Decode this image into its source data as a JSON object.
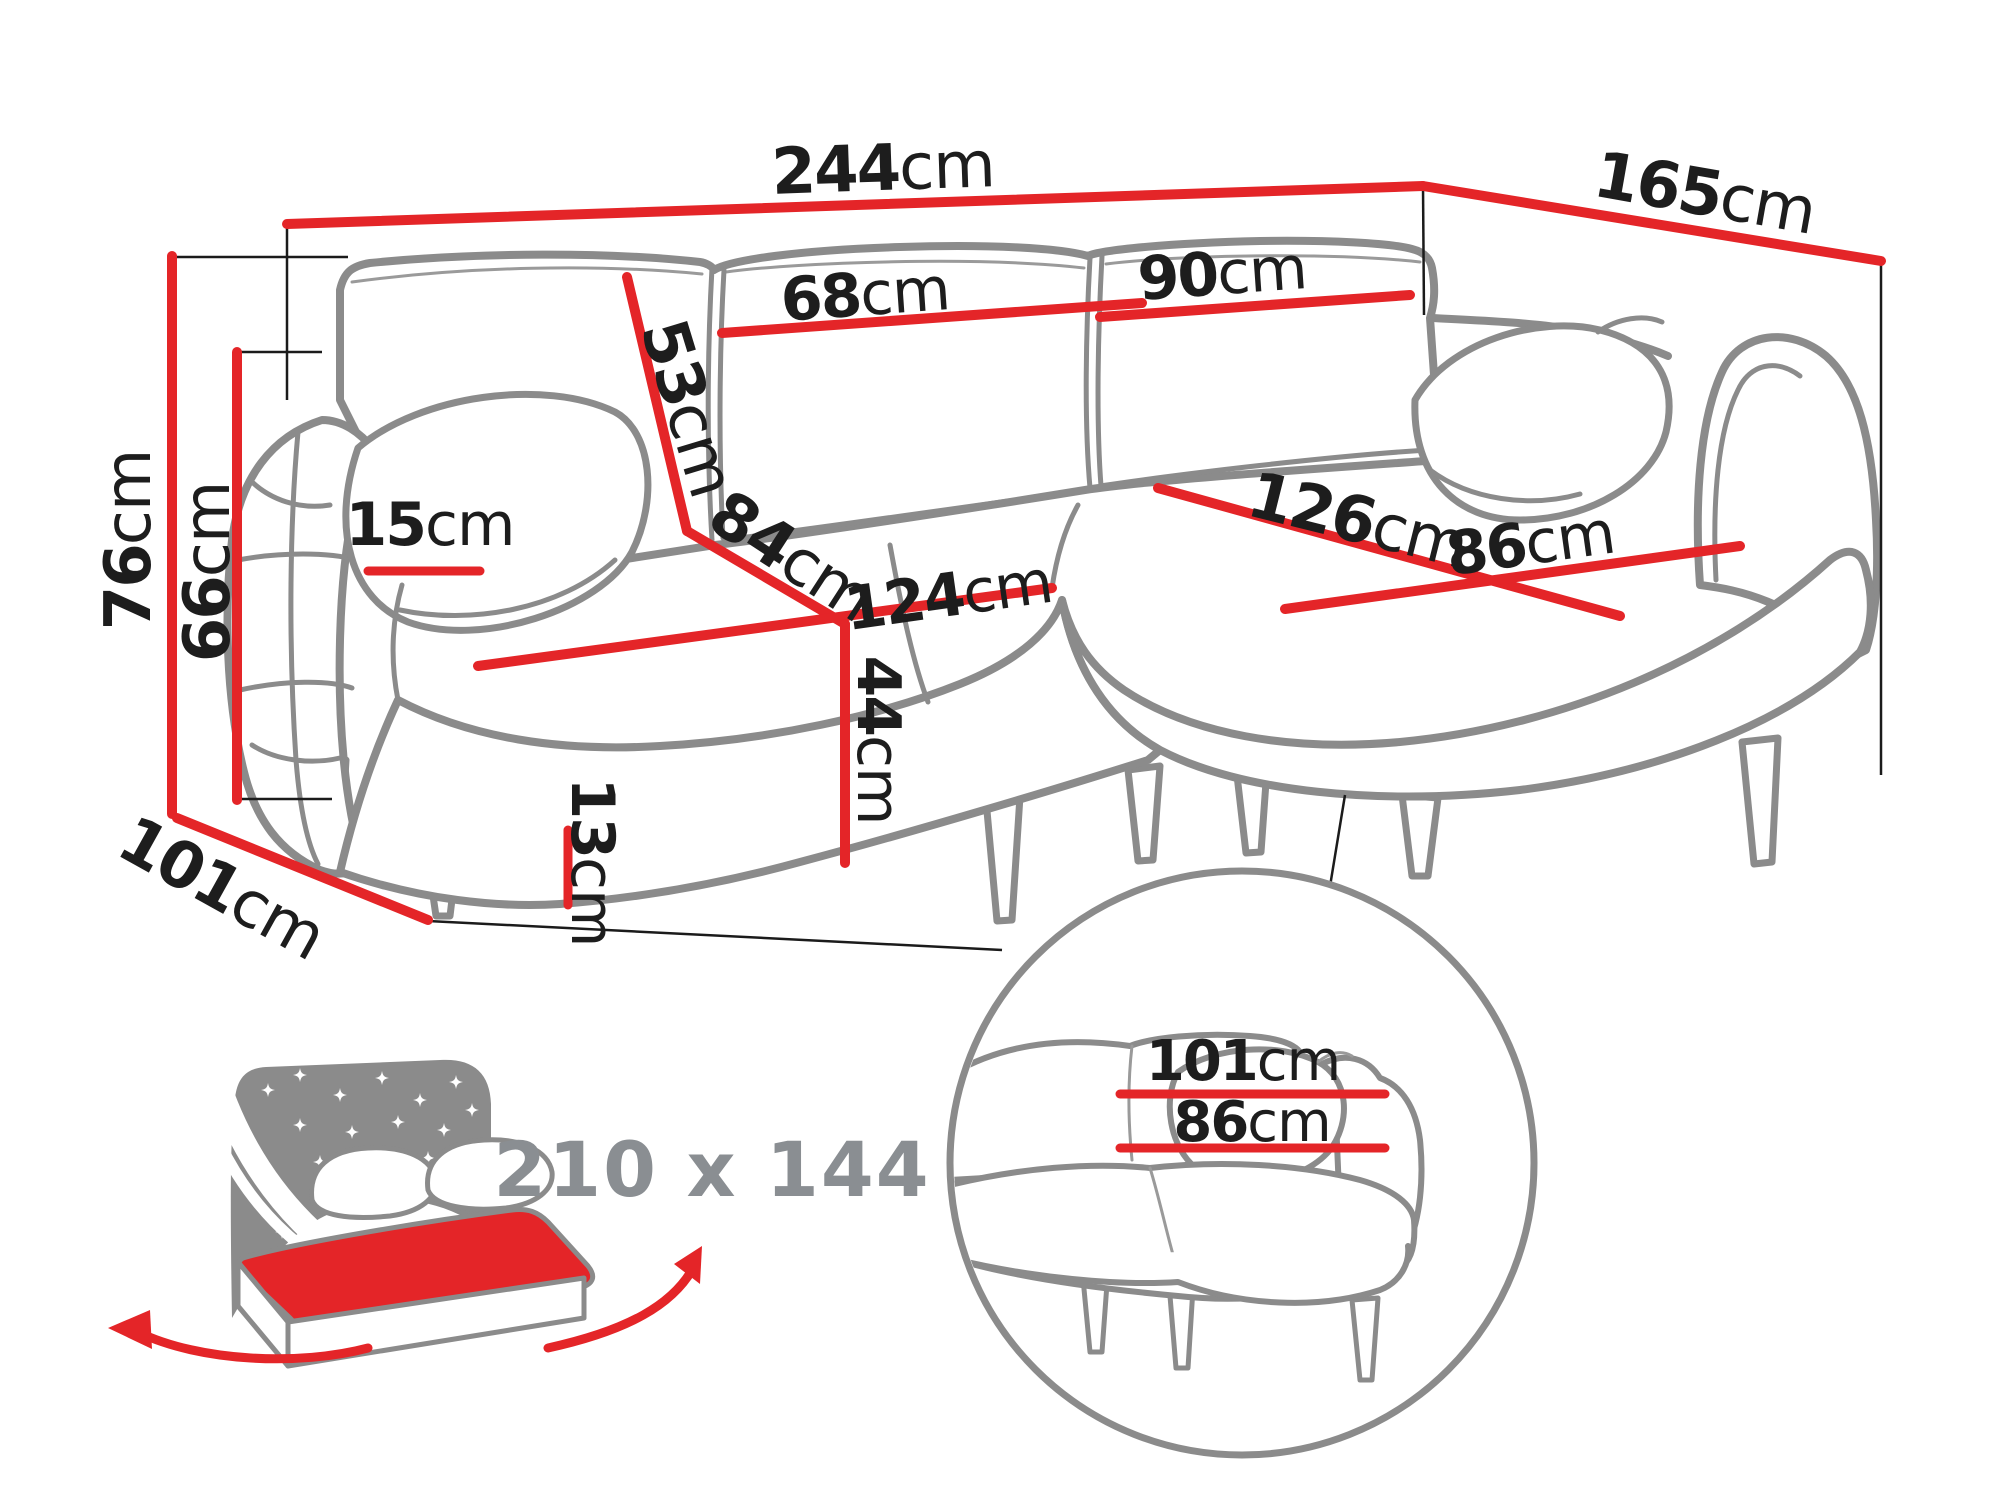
{
  "title": "Corner sofa dimensions diagram",
  "colors": {
    "dimension_red": "#e42528",
    "outline_gray": "#8b8b8b",
    "label_black": "#1d1d1d",
    "muted_gray": "#8a8e92"
  },
  "dimensions": {
    "total_width": {
      "value": "244",
      "unit": "cm"
    },
    "total_depth": {
      "value": "165",
      "unit": "cm"
    },
    "total_height": {
      "value": "76",
      "unit": "cm"
    },
    "armrest_height": {
      "value": "66",
      "unit": "cm"
    },
    "side_depth": {
      "value": "101",
      "unit": "cm"
    },
    "armrest_width": {
      "value": "15",
      "unit": "cm"
    },
    "backrest_height": {
      "value": "53",
      "unit": "cm"
    },
    "back_cushion_width": {
      "value": "68",
      "unit": "cm"
    },
    "back_cushion_large": {
      "value": "90",
      "unit": "cm"
    },
    "seat_depth": {
      "value": "84",
      "unit": "cm"
    },
    "seat_width": {
      "value": "124",
      "unit": "cm"
    },
    "chaise_length": {
      "value": "126",
      "unit": "cm"
    },
    "chaise_width": {
      "value": "86",
      "unit": "cm"
    },
    "seat_height": {
      "value": "44",
      "unit": "cm"
    },
    "leg_height": {
      "value": "13",
      "unit": "cm"
    }
  },
  "sleeping_function": {
    "bed_size": "210 x 144"
  },
  "detail_view": {
    "backrest_width": {
      "value": "101",
      "unit": "cm"
    },
    "seat_width": {
      "value": "86",
      "unit": "cm"
    }
  }
}
